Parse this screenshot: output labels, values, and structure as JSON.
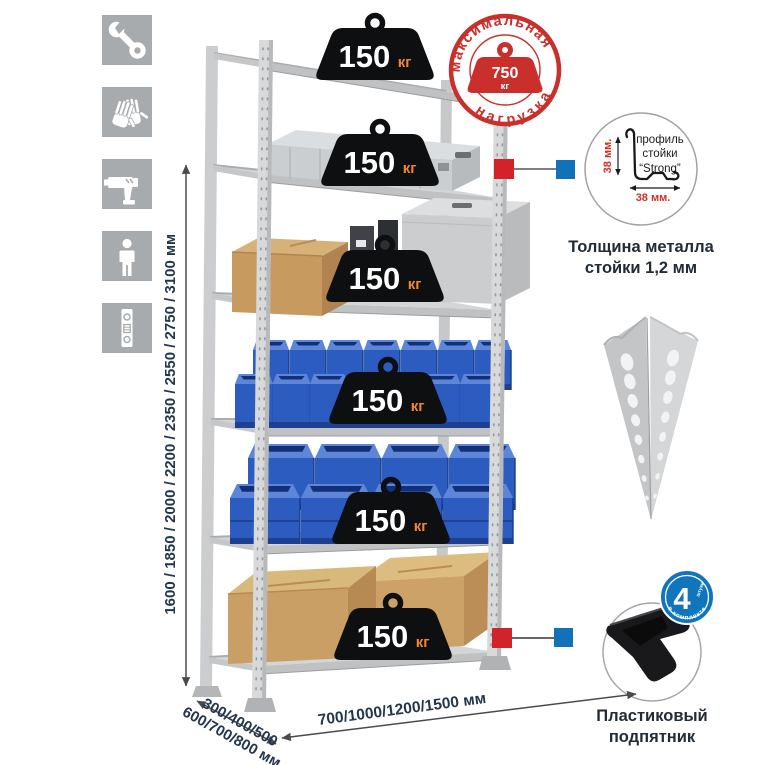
{
  "page": {
    "background": "#ffffff"
  },
  "left_icons": [
    {
      "name": "wrench-icon"
    },
    {
      "name": "gloves-icon"
    },
    {
      "name": "drill-icon"
    },
    {
      "name": "person-icon"
    },
    {
      "name": "level-icon"
    }
  ],
  "dimensions": {
    "height": "1600 / 1850 / 2000 / 2200 / 2350 / 2550 / 2750 / 3100 мм",
    "depth_line1": "300/400/500",
    "depth_line2": "600/700/800 мм",
    "width": "700/1000/1200/1500 мм"
  },
  "shelf_load": {
    "value": "150",
    "unit": "кг",
    "shelf_count": 6
  },
  "max_load_stamp": {
    "arc_top": "максимальная",
    "arc_bottom": "нагрузка",
    "value": "750",
    "unit": "кг"
  },
  "profile_detail": {
    "line1": "профиль",
    "line2": "стойки",
    "line3": "“Strong”",
    "dim_vertical": "38 мм.",
    "dim_horizontal": "38 мм.",
    "caption_line1": "Толщина металла",
    "caption_line2": "стойки 1,2 мм"
  },
  "foot_detail": {
    "badge_number": "4",
    "badge_word": "штуки",
    "badge_arc": "в комплекте",
    "caption_line1": "Пластиковый",
    "caption_line2": "подпятник"
  },
  "colors": {
    "stamp_red": "#c9302c",
    "marker_red": "#d2232a",
    "marker_blue": "#1272b8",
    "badge_blue": "#1175bb",
    "bin_blue": "#2c5cc0",
    "weight_black": "#0e0f10",
    "unit_orange": "#f2862b",
    "label_navy": "#24364e",
    "icon_gray": "#a8abad",
    "metal_gray": "#d3d5d7"
  }
}
